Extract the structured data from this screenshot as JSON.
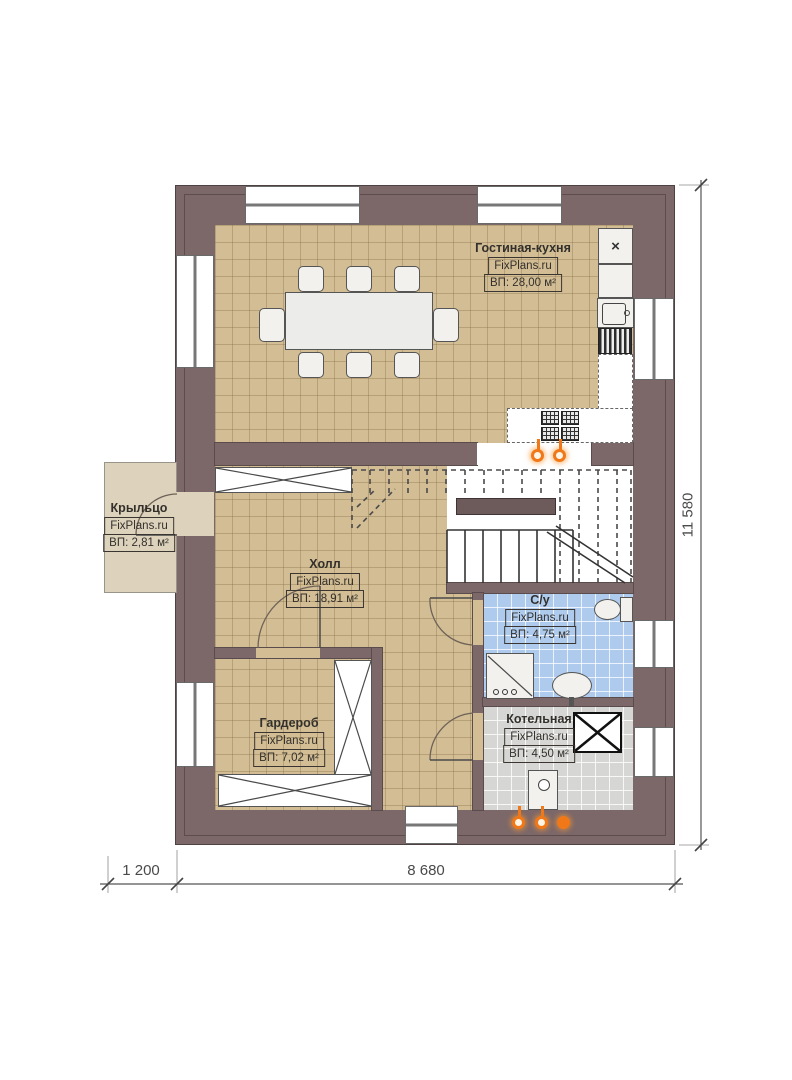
{
  "plan": {
    "title": "Floor plan — first floor",
    "rooms": [
      {
        "key": "living-kitchen",
        "name": "Гостиная-кухня",
        "site": "FixPlans.ru",
        "area": "ВП: 28,00 м²"
      },
      {
        "key": "hall",
        "name": "Холл",
        "site": "FixPlans.ru",
        "area": "ВП: 18,91 м²"
      },
      {
        "key": "porch",
        "name": "Крыльцо",
        "site": "FixPlans.ru",
        "area": "ВП: 2,81 м²"
      },
      {
        "key": "bathroom",
        "name": "С/у",
        "site": "FixPlans.ru",
        "area": "ВП: 4,75 м²"
      },
      {
        "key": "wardrobe",
        "name": "Гардероб",
        "site": "FixPlans.ru",
        "area": "ВП: 7,02 м²"
      },
      {
        "key": "boiler",
        "name": "Котельная",
        "site": "FixPlans.ru",
        "area": "ВП: 4,50 м²"
      }
    ],
    "dimensions": {
      "height_total": "11 580",
      "width_main": "8 680",
      "width_porch": "1 200"
    },
    "icons": {
      "fridge_glyph": "×"
    },
    "colors": {
      "wall": "#7c6869",
      "floor_wood": "#d2bd94",
      "floor_bath": "#aecbee",
      "floor_boiler": "#d6d6d4",
      "porch": "#ddd2bb",
      "accent_orange": "#f07818"
    }
  }
}
